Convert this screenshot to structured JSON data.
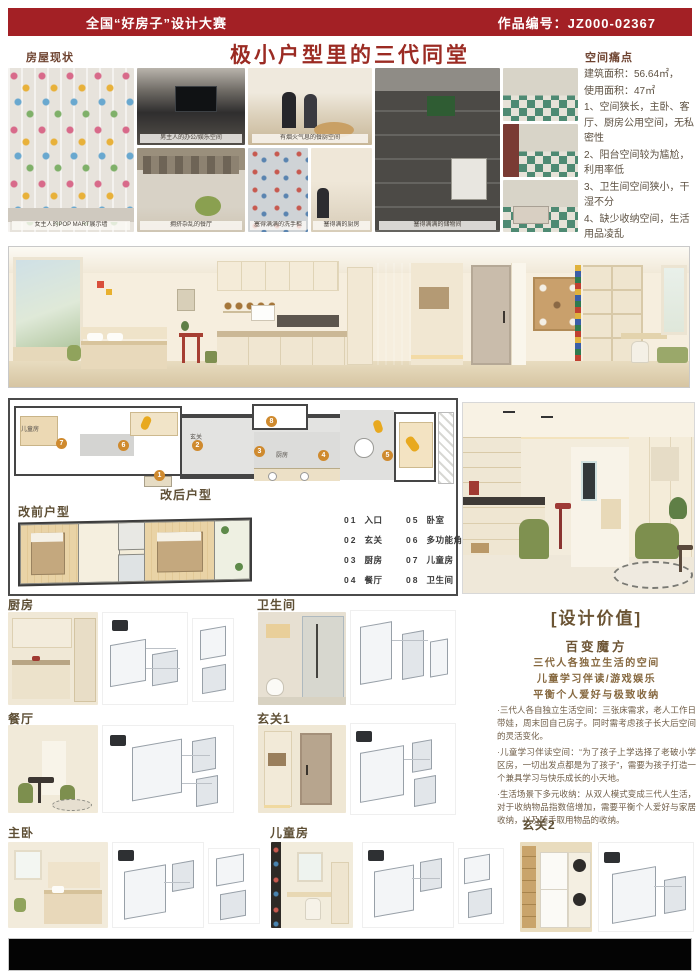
{
  "colors": {
    "brand_red": "#a32025",
    "title_red": "#9b2b23",
    "label_brown": "#5e4f35",
    "accent_orange": "#cf8a2e"
  },
  "header": {
    "competition": "全国“好房子”设计大赛",
    "entry_no": "作品编号：JZ000-02367"
  },
  "title": "极小户型里的三代同堂",
  "status": {
    "label": "房屋现状",
    "captions": [
      "女主人的POP MART展示墙",
      "男主人的办公/娱乐空间",
      "拥挤杂乱的餐厅",
      "有烟火气息的餐厨空间",
      "塞得满满的洗手柜",
      "塞得满的厨房",
      "塞得满满的储物间"
    ]
  },
  "pain": {
    "label": "空间痛点",
    "lines": [
      "建筑面积：56.64㎡，",
      "使用面积：47㎡",
      "1、空间狭长，主卧、客厅、厨房公用空间，无私密性",
      "2、阳台空间较为尴尬，利用率低",
      "3、卫生间空间狭小，干湿不分",
      "4、缺少收纳空间，生活用品凌乱"
    ]
  },
  "plan": {
    "after_label": "改后户型",
    "before_label": "改前户型",
    "rooms": {
      "kids": "儿童房",
      "foyer": "玄关",
      "kitchen": "厨房"
    },
    "markers": [
      "1",
      "2",
      "3",
      "4",
      "5",
      "6",
      "7",
      "8"
    ],
    "legend": [
      {
        "n": "01",
        "t": "入口"
      },
      {
        "n": "02",
        "t": "玄关"
      },
      {
        "n": "03",
        "t": "厨房"
      },
      {
        "n": "04",
        "t": "餐厅"
      },
      {
        "n": "05",
        "t": "卧室"
      },
      {
        "n": "06",
        "t": "多功能角"
      },
      {
        "n": "07",
        "t": "儿童房"
      },
      {
        "n": "08",
        "t": "卫生间"
      }
    ]
  },
  "value": {
    "heading": "[设计价值]",
    "subheading": "百变魔方",
    "highlights": [
      "三代人各独立生活的空间",
      "儿童学习伴读/游戏娱乐",
      "平衡个人爱好与极致收纳"
    ],
    "bullets": [
      "·三代人各自独立生活空间：三张床需求，老人工作日带娃，周末回自己房子。同时需考虑孩子长大后空间的灵活变化。",
      "·儿童学习伴读空间：“为了孩子上学选择了老破小学区房，一切出发点都是为了孩子”，需要为孩子打造一个兼具学习与快乐成长的小天地。",
      "·生活场景下多元收纳：从双人模式变成三代人生活，对于收纳物品指数倍增加，需要平衡个人爱好与家居收纳，以及随手取用物品的收纳。"
    ]
  },
  "sections": {
    "kitchen": "厨房",
    "bathroom": "卫生间",
    "dining": "餐厅",
    "foyer1": "玄关1",
    "master": "主卧",
    "kids": "儿童房",
    "foyer2": "玄关2"
  }
}
